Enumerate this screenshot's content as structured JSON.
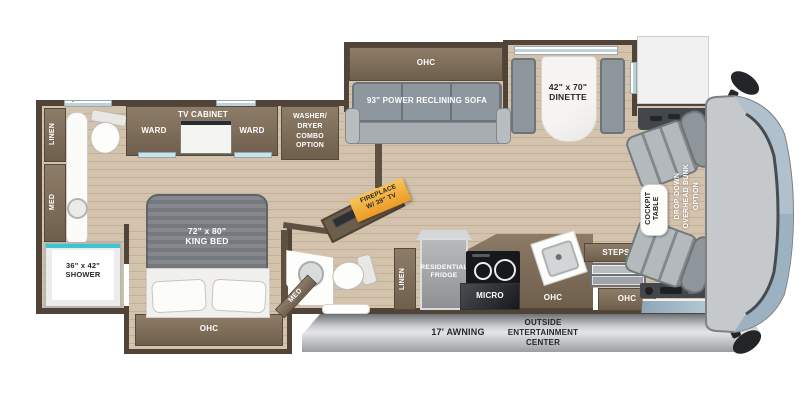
{
  "floorplan_title": "Class A motorhome floor plan",
  "labels": {
    "rear_linen": "LINEN",
    "rear_med": "MED",
    "shower_size": "36\" x 42\"",
    "shower_name": "SHOWER",
    "ward_left": "WARD",
    "tv_cabinet": "TV CABINET",
    "ward_right": "WARD",
    "washer_l1": "WASHER/",
    "washer_l2": "DRYER",
    "washer_l3": "COMBO",
    "washer_l4": "OPTION",
    "bed_size": "72\" x 80\"",
    "bed_name": "KING BED",
    "bed_ohc": "OHC",
    "sofa_ohc": "OHC",
    "sofa": "93\" POWER RECLINING SOFA",
    "dinette_size": "42\" x 70\"",
    "dinette_name": "DINETTE",
    "fireplace_l1": "FIREPLACE",
    "fireplace_l2": "W/ 39\" TV",
    "mid_med": "MED",
    "mid_linen": "LINEN",
    "fridge_l1": "RESIDENTIAL",
    "fridge_l2": "FRIDGE",
    "micro": "MICRO",
    "kitchen_ohc": "OHC",
    "entry_ohc": "OHC",
    "steps": "STEPS",
    "cockpit_l1": "COCKPIT",
    "cockpit_l2": "TABLE",
    "bunk_l1": "DROP-DOWN",
    "bunk_l2": "OVERHEAD BUNK",
    "bunk_l3": "OPTION",
    "awning": "17' AWNING",
    "outside_l1": "OUTSIDE",
    "outside_l2": "ENTERTAINMENT",
    "outside_l3": "CENTER"
  },
  "colors": {
    "wall_brown": "#5e5142",
    "cabinet_brown": "#7b6b58",
    "floor_tan": "#d0bea7",
    "cushion_gray": "#99a0a5",
    "fireplace_accent": "#f2a93b",
    "shower_teal": "#3cc4d0",
    "front_cap_gray": "#c6c9cb",
    "windshield_blue": "#b0c1cd"
  }
}
